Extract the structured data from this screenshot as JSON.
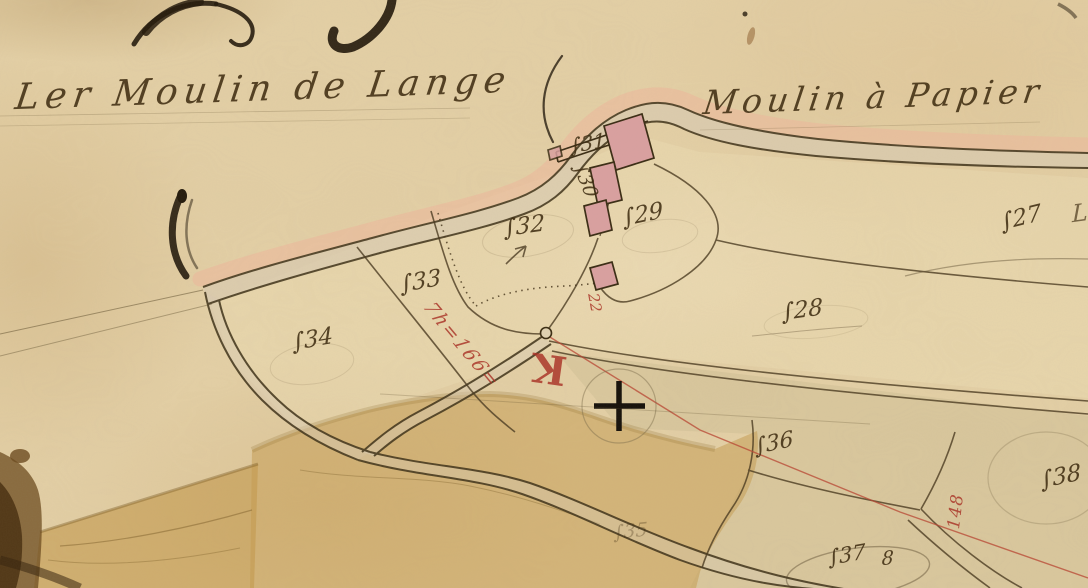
{
  "map": {
    "region_titles": {
      "left": "Ler Moulin de Lange",
      "right": "Moulin à Papier"
    },
    "parcel_labels": [
      {
        "value": "531",
        "display": "∫31"
      },
      {
        "value": "530",
        "display": "∫30"
      },
      {
        "value": "532",
        "display": "∫32"
      },
      {
        "value": "529",
        "display": "∫29"
      },
      {
        "value": "527",
        "display": "∫27"
      },
      {
        "value": "533",
        "display": "∫33"
      },
      {
        "value": "528",
        "display": "∫28"
      },
      {
        "value": "534",
        "display": "∫34"
      },
      {
        "value": "536",
        "display": "∫36"
      },
      {
        "value": "535",
        "display": "∫35"
      },
      {
        "value": "537",
        "display": "∫37"
      },
      {
        "value": "8",
        "display": "8"
      },
      {
        "value": "538",
        "display": "∫38"
      },
      {
        "value": "L",
        "display": "L"
      }
    ],
    "red_annotations": {
      "survey_note": "7h=166=",
      "letter_k": "K",
      "number_22": "22",
      "number_148": "148"
    },
    "symbols": [
      "survey-cross",
      "junction-circle",
      "arrow-mark"
    ],
    "colors": {
      "paper": "#e4d0a6",
      "ink": "#4a3a20",
      "red_ink": "#b03a2e",
      "road_pink": "#edb99c",
      "building_pink": "#d9a0a0",
      "tan_wash": "#c49a4e",
      "dark_wash": "#5a3c16"
    }
  }
}
